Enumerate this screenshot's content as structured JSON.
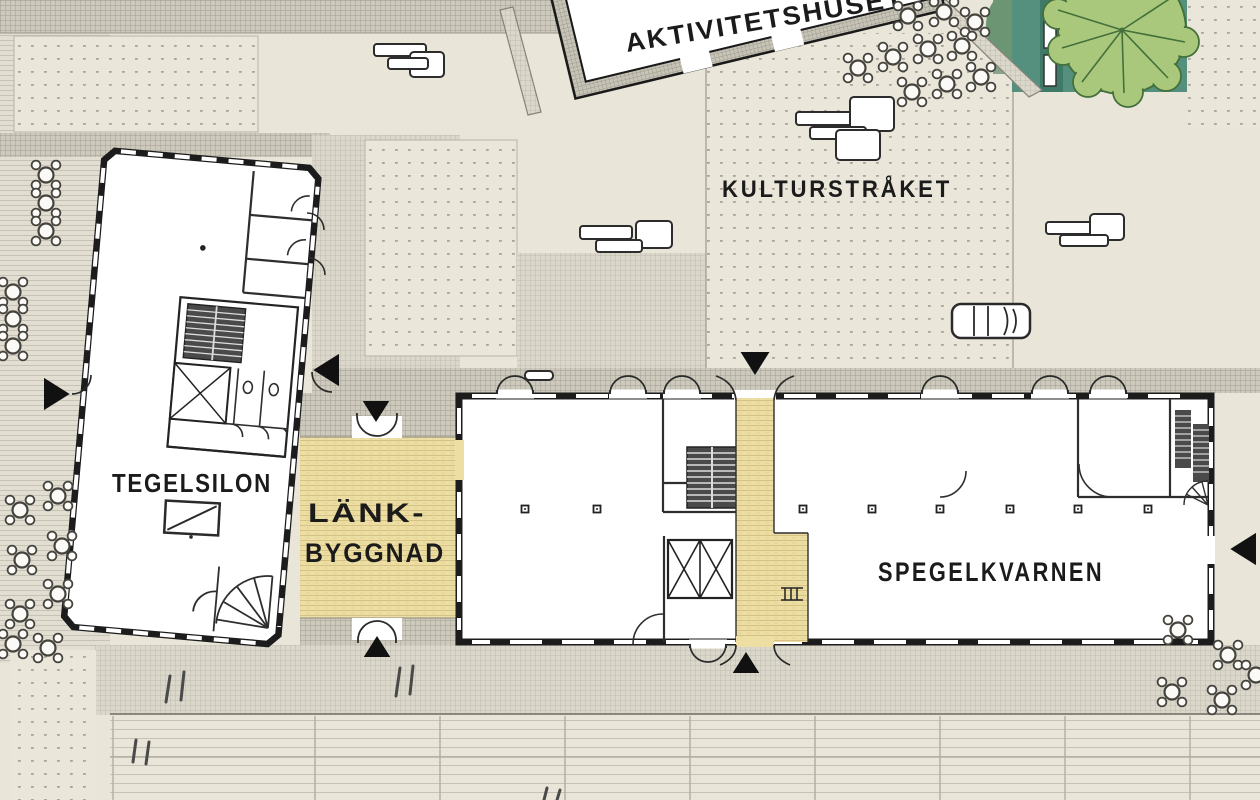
{
  "plan": {
    "labels": {
      "aktivitetshuset": "AKTIVITETSHUSET",
      "kulturstraket": "KULTURSTRÅKET",
      "tegelsilon": "TEGELSILON",
      "lankbyggnad_line1": "LÄNK-",
      "lankbyggnad_line2": "BYGGNAD",
      "spegelkvarnen": "SPEGELKVARNEN"
    },
    "colors": {
      "paper": "#e9e5d8",
      "wall_ink": "#1c1c1c",
      "deck_yellow": "#eddfa3",
      "park_green": "#55907e",
      "park_strip_green": "#3f7a68",
      "tree_green": "#a9c87b",
      "tree_outline": "#44703c",
      "hatch_gray": "#dbd8cb"
    },
    "icons": {
      "entrance_arrow": "filled-black-triangle",
      "outdoor_table": "round-table-with-four-chairs",
      "bench": "white-rounded-rectangle",
      "tree": "lobed-tree-canopy",
      "car": "parked-car-top-view",
      "stairs": "tread-line-block",
      "elevator": "crossed-box",
      "door": "quarter-circle-swing-arc"
    }
  }
}
